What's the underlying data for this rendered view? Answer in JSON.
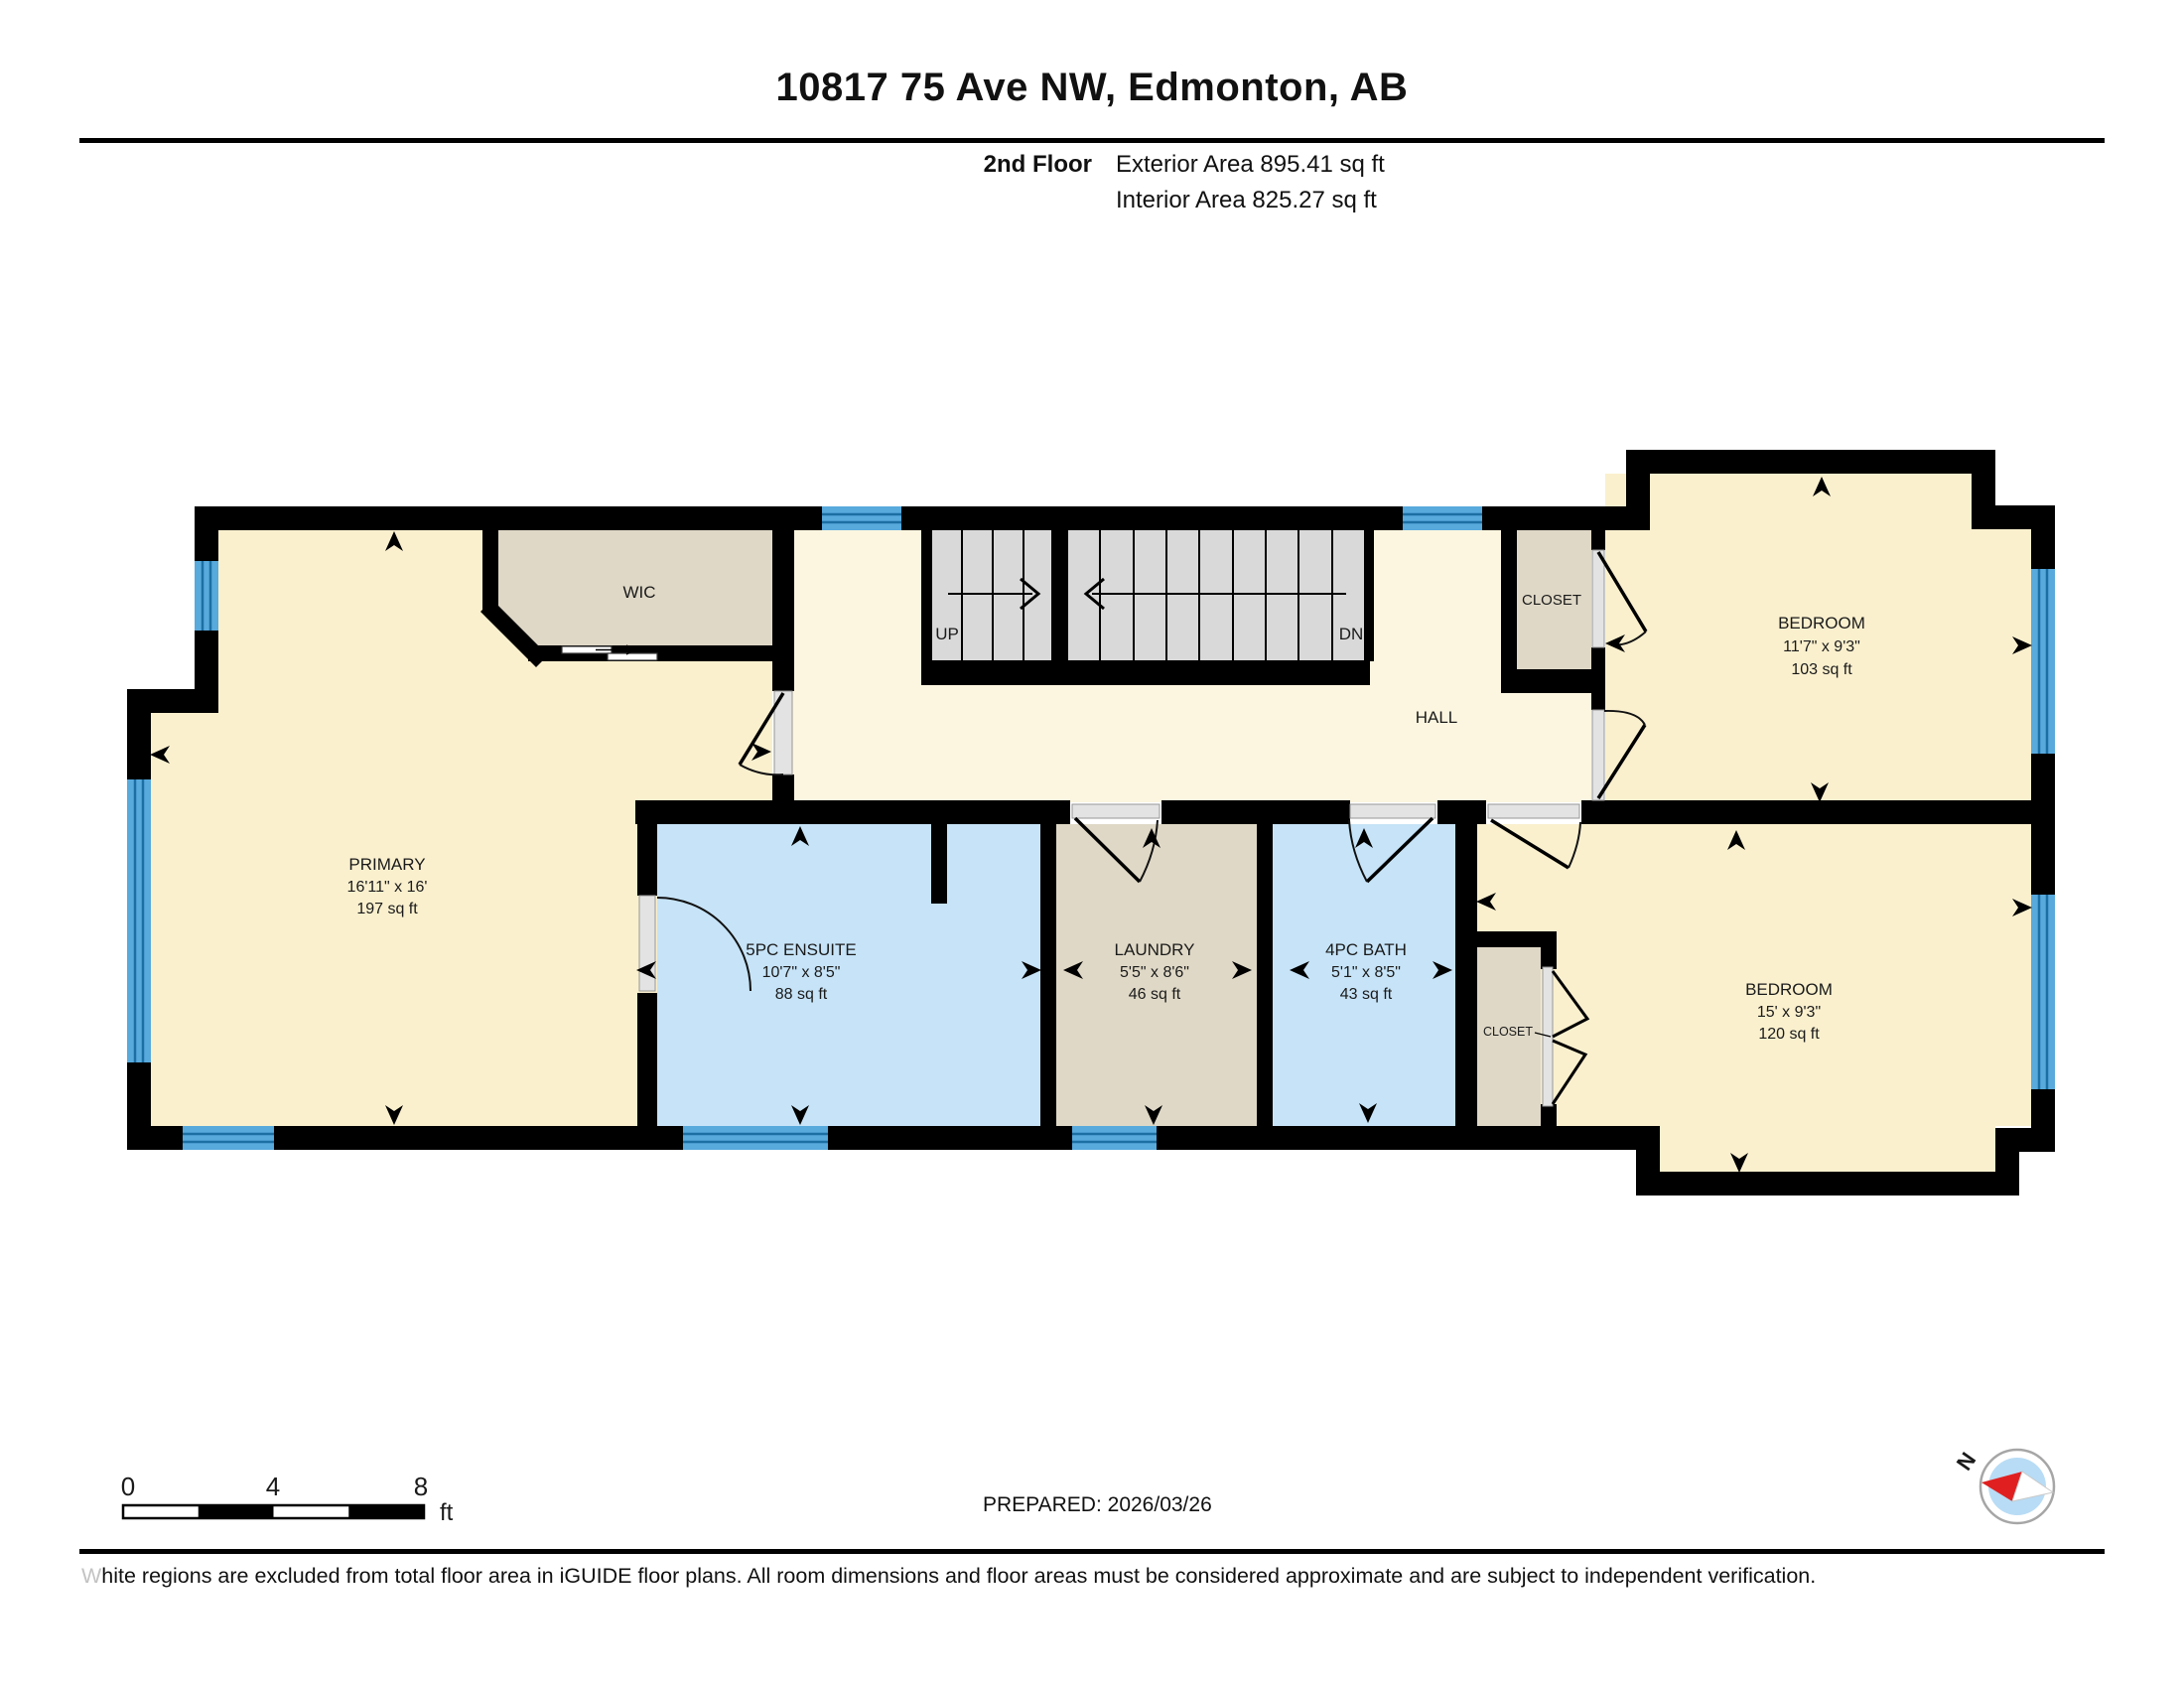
{
  "header": {
    "title": "10817 75 Ave NW, Edmonton, AB",
    "floor_label": "2nd Floor",
    "exterior_area": "Exterior Area 895.41 sq ft",
    "interior_area": "Interior Area 825.27 sq ft"
  },
  "plan": {
    "rooms": {
      "primary": {
        "name": "PRIMARY",
        "dims": "16'11\" x 16'",
        "area": "197 sq ft"
      },
      "wic": {
        "name": "WIC"
      },
      "hall": {
        "name": "HALL"
      },
      "closet_upper": {
        "name": "CLOSET"
      },
      "bedroom_upper": {
        "name": "BEDROOM",
        "dims": "11'7\" x 9'3\"",
        "area": "103 sq ft"
      },
      "ensuite": {
        "name": "5PC ENSUITE",
        "dims": "10'7\" x 8'5\"",
        "area": "88 sq ft"
      },
      "laundry": {
        "name": "LAUNDRY",
        "dims": "5'5\" x 8'6\"",
        "area": "46 sq ft"
      },
      "bath": {
        "name": "4PC BATH",
        "dims": "5'1\" x 8'5\"",
        "area": "43 sq ft"
      },
      "closet_lower": {
        "name": "CLOSET"
      },
      "bedroom_lower": {
        "name": "BEDROOM",
        "dims": "15' x 9'3\"",
        "area": "120 sq ft"
      }
    },
    "stairs": {
      "up_label": "UP",
      "down_label": "DN"
    }
  },
  "scale_bar": {
    "start": "0",
    "mid": "4",
    "end": "8",
    "unit": "ft"
  },
  "compass": {
    "north_label": "N"
  },
  "footer": {
    "prepared_label": "PREPARED: 2026/03/26",
    "disclaimer_lead": "W",
    "disclaimer_rest": "hite regions are excluded from total floor area in iGUIDE floor plans. All room dimensions and floor areas must be considered approximate and are subject to independent verification."
  },
  "colors": {
    "wall": "#000000",
    "room_cream": "#FAF0CE",
    "hall_cream": "#FCF6E0",
    "closet_tan": "#DFD8C6",
    "bath_blue": "#C6E3F7",
    "window_blue": "#58A9DC",
    "stair_gray": "#D9D9D9",
    "compass_needle_red": "#E02020",
    "compass_face_blue": "#B8DCF5"
  }
}
